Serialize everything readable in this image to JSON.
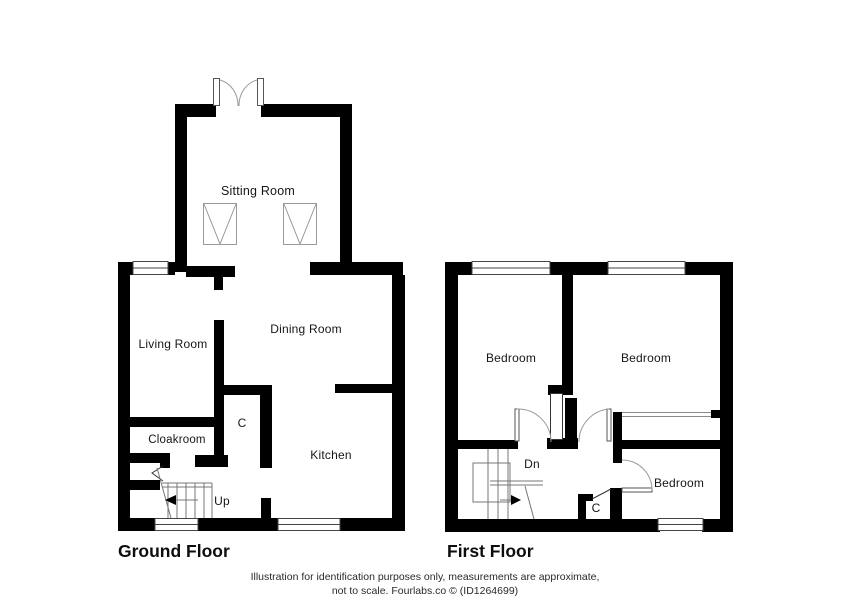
{
  "ground": {
    "title": "Ground Floor",
    "labels": {
      "sitting": "Sitting Room",
      "living": "Living Room",
      "dining": "Dining Room",
      "cloakroom": "Cloakroom",
      "closet": "C",
      "kitchen": "Kitchen",
      "stairs_direction": "Up"
    }
  },
  "first": {
    "title": "First Floor",
    "labels": {
      "bedroom_left": "Bedroom",
      "bedroom_right": "Bedroom",
      "bedroom_bottom": "Bedroom",
      "closet": "C",
      "stairs_direction": "Dn"
    }
  },
  "footer": {
    "line1": "Illustration for identification purposes only, measurements are approximate,",
    "line2": "not to scale. Fourlabs.co © (ID1264699)"
  },
  "colors": {
    "wall": "#000000",
    "door_arc": "#9a9a9a",
    "detail_line": "#555555",
    "text": "#1a1a1a"
  }
}
